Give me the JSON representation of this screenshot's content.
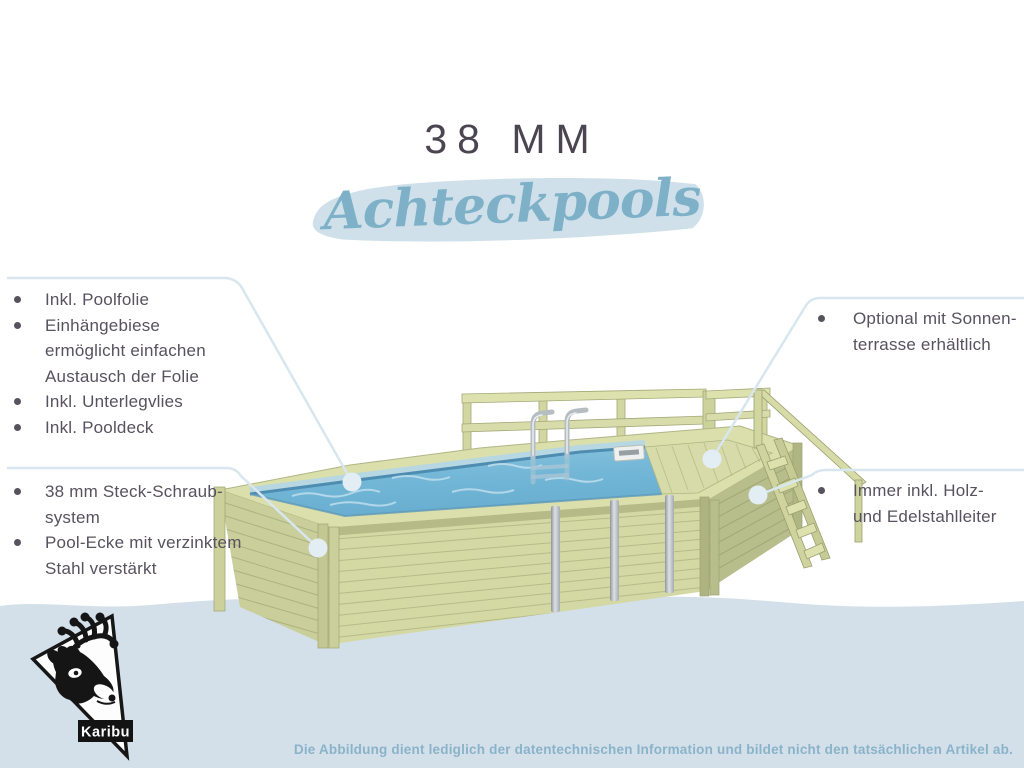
{
  "title": {
    "kicker": "38 MM",
    "script": "Achteckpools"
  },
  "callouts": {
    "top_left": {
      "items": [
        {
          "lines": [
            "Inkl. Poolfolie"
          ]
        },
        {
          "lines": [
            "Einhängebiese",
            "ermöglicht einfachen",
            "Austausch der Folie"
          ]
        },
        {
          "lines": [
            "Inkl. Unterlegvlies"
          ]
        },
        {
          "lines": [
            "Inkl. Pooldeck"
          ]
        }
      ]
    },
    "bottom_left": {
      "items": [
        {
          "lines": [
            "38 mm Steck-Schraub-",
            "system"
          ]
        },
        {
          "lines": [
            "Pool-Ecke mit verzinktem",
            "Stahl verstärkt"
          ]
        }
      ]
    },
    "top_right": {
      "items": [
        {
          "lines": [
            "Optional mit Sonnen-",
            "terrasse erhältlich"
          ]
        }
      ]
    },
    "bottom_right": {
      "items": [
        {
          "lines": [
            "Immer inkl. Holz-",
            "und Edelstahlleiter"
          ]
        }
      ]
    }
  },
  "footer": {
    "disclaimer": "Die Abbildung dient lediglich der datentechnischen Information und bildet nicht den tatsächlichen Artikel ab."
  },
  "logo": {
    "brand": "Karibu"
  },
  "illustration": {
    "subject": "wooden octagon pool with sun deck, railing, outer wood stairs and inner stainless ladder"
  },
  "colors": {
    "background_blue": "#d3e0ea",
    "brush_blue": "#cfe0ea",
    "script_blue": "#7eb1c8",
    "title_dark": "#4b4551",
    "body_text": "#57525e",
    "disclaimer_blue": "#8ab3c9",
    "callout_line": "#d8e6f0",
    "callout_dot": "#e3edf4",
    "wood_light": "#d6daa5",
    "wood_mid": "#c9ce9a",
    "wood_dark": "#b7bd8b",
    "water_blue": "#74b7d7",
    "liner_blue": "#4e8db1",
    "metal_gray": "#b6bdc2"
  }
}
